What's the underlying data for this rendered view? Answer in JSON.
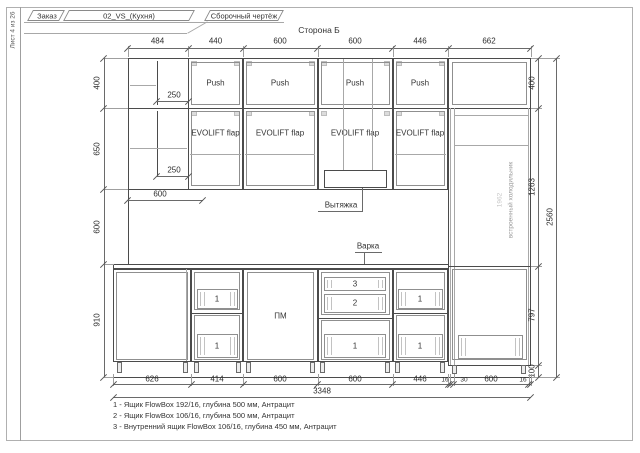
{
  "sheet": {
    "sheet_label": "Лист 4 из 26",
    "header": {
      "order_label": "Заказ",
      "order_value": "02_VS_(Кухня)",
      "doc_title": "Сборочный чертёж"
    },
    "view_title": "Сторона Б"
  },
  "cabinet_labels": {
    "push": "Push",
    "evolift_flap": "EVOLIFT flap",
    "hood": "Вытяжка",
    "cooktop": "Варка",
    "dishwasher": "ПМ",
    "fridge_niche_height": "1962",
    "fridge_note": "встроенный холодильник",
    "drawer_1": "1",
    "drawer_2": "2",
    "drawer_3": "3"
  },
  "dimensions": {
    "top": [
      "484",
      "440",
      "600",
      "600",
      "446",
      "662"
    ],
    "left": [
      "400",
      "650",
      "600",
      "910"
    ],
    "right": [
      "400",
      "1263",
      "797",
      "100"
    ],
    "right_total": "2560",
    "bottom": [
      "626",
      "414",
      "600",
      "600",
      "446",
      "16",
      "30",
      "600",
      "16"
    ],
    "bottom_total": "3348",
    "shelf_250_a": "250",
    "shelf_250_b": "250",
    "upper_600": "600"
  },
  "notes": [
    "1 - Ящик FlowBox 192/16, глубина 500 мм, Антрацит",
    "2 - Ящик FlowBox 106/16, глубина 500 мм, Антрацит",
    "3 - Внутренний ящик FlowBox 106/16, глубина 450 мм, Антрацит"
  ],
  "colors": {
    "line": "#4b4b4b",
    "dim": "#555555",
    "muted": "#9b9b9b",
    "faint": "#c6c6c6"
  }
}
